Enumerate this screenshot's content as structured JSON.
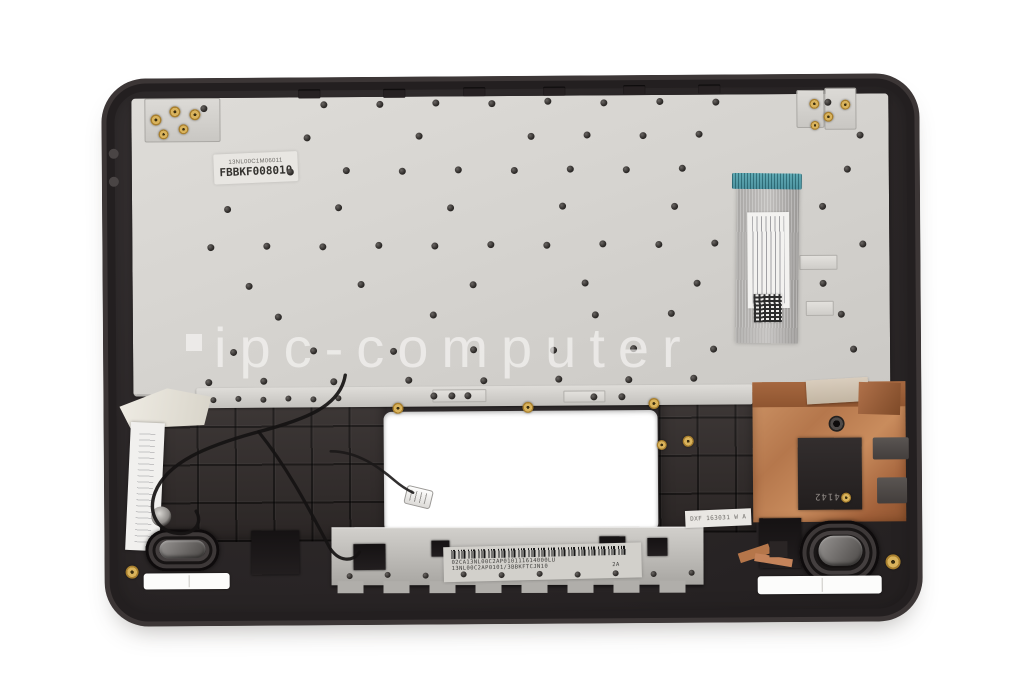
{
  "watermark": {
    "text": "ipc-computer"
  },
  "labels": {
    "keyboard_serial": {
      "line1": "13NL00C1M06011",
      "line2": "FBBKF008010"
    },
    "bracket_barcode": {
      "line1": "02CA13NL00C2AP010111614000LU",
      "line2": "13NL00C2AP0101/3BBKFTCJN10",
      "suffix": "2A"
    },
    "heatsink_pad": {
      "text": "F4142"
    },
    "inspection_sticker": {
      "text": "DXF 163031 W A"
    }
  },
  "colors": {
    "background": "#ffffff",
    "chassis": "#2b2627",
    "keyboard_plate": "#d6d4d0",
    "copper_heatsink": "#b5774c",
    "ffc_connector_teal": "#5fa8b2",
    "bracket_metal": "#c3c1bd",
    "brass_insert": "#c8a04e"
  }
}
